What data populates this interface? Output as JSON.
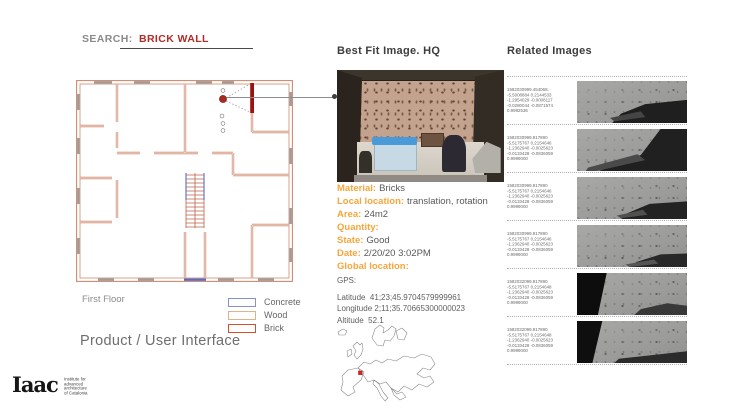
{
  "header": {
    "search_label": "SEARCH:",
    "query": "BRICK WALL"
  },
  "floor_plan": {
    "caption": "First Floor",
    "legend": [
      {
        "label": "Concrete",
        "color": "#8891c9"
      },
      {
        "label": "Wood",
        "color": "#d9b48c"
      },
      {
        "label": "Brick",
        "color": "#d0512c"
      }
    ]
  },
  "best_fit": {
    "title": "Best Fit Image. HQ",
    "details": [
      {
        "label": "Material:",
        "value": "Bricks"
      },
      {
        "label": "Local location:",
        "value": "translation, rotation"
      },
      {
        "label": "Area:",
        "value": "24m2"
      },
      {
        "label": "Quantity:",
        "value": ""
      },
      {
        "label": "State:",
        "value": "Good"
      },
      {
        "label": "Date:",
        "value": "2/20/20 3:02PM"
      }
    ],
    "global_location_label": "Global location:",
    "gps": {
      "title": "GPS:",
      "lines": [
        {
          "label": "Latitude",
          "value": "41;23;45.9704579999961"
        },
        {
          "label": "Longitude",
          "value": "2;11;35.70665300000023"
        },
        {
          "label": "Altitude",
          "value": "52.1"
        }
      ]
    }
  },
  "related": {
    "title": "Related Images",
    "rows": [
      {
        "lines": [
          "1582030999.454068.",
          "-5.5008884 0.2144533",
          "-1.2954029 -0.0008117",
          "-0.0280044 -0.0871574",
          "0.9992536"
        ]
      },
      {
        "lines": [
          "1582030999.917890",
          "-5.5175767 0.2154646",
          "-1.2362940 -0.0025623",
          "-0.0133428 -0.0836059",
          "0.9999000"
        ]
      },
      {
        "lines": [
          "1582030999.917890",
          "-5.5175767 0.2154646",
          "-1.2362940 -0.0025623",
          "-0.0133428 -0.0836059",
          "0.9999000"
        ]
      },
      {
        "lines": [
          "1582030999.917890",
          "-5.5175767 0.2154646",
          "-1.2362940 -0.0025623",
          "-0.0133428 -0.0836059",
          "0.9999000"
        ]
      },
      {
        "lines": [
          "1582032099.917890",
          "-5.5175767 0.2154648",
          "-1.2362940 -0.0025623",
          "-0.0133428 -0.0836059",
          "0.9999000"
        ]
      },
      {
        "lines": [
          "1582032099.917890",
          "-5.5175767 0.2154648",
          "-1.2362940 -0.0025623",
          "-0.0133428 -0.0836059",
          "0.9999000"
        ]
      }
    ]
  },
  "footer": {
    "product_label": "Product / User Interface",
    "logo_text": "Iaac",
    "logo_sub_lines": [
      "Institute for",
      "advanced",
      "architecture",
      "of Catalonia"
    ]
  },
  "colors": {
    "accent_red": "#b32b25",
    "label_orange": "#f5a63c",
    "plan_wall": "#cf8a6e",
    "selected_wall": "#9c120c",
    "marker_red": "#a82a1e"
  }
}
